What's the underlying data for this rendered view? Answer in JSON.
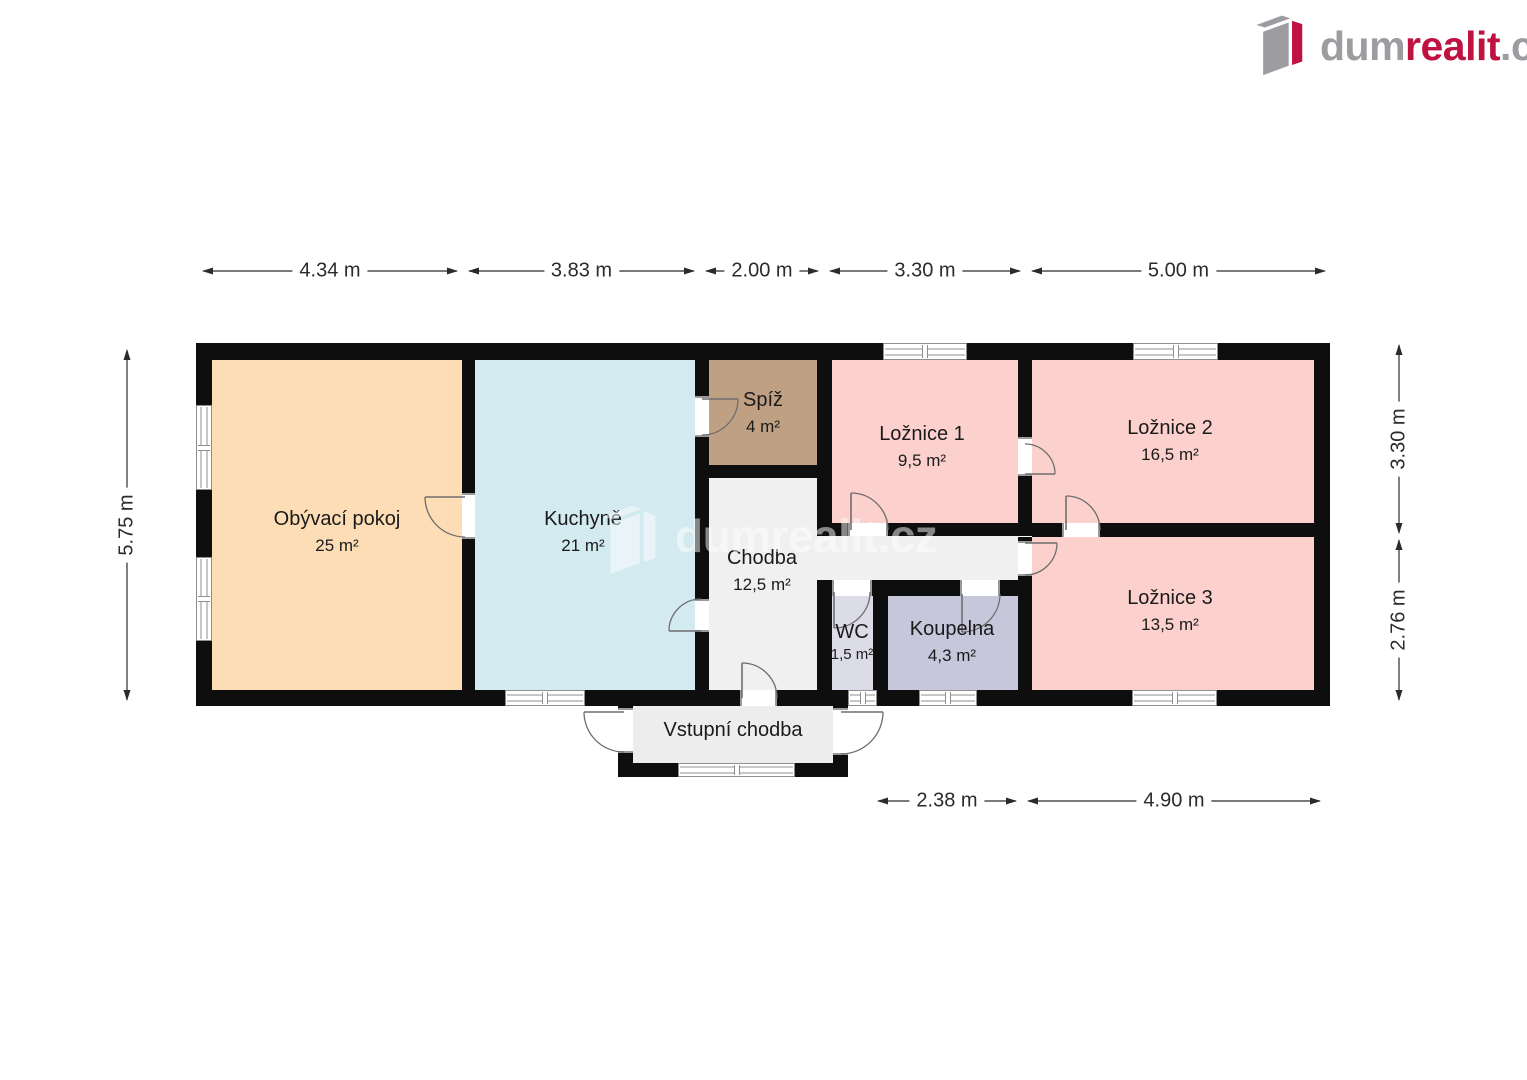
{
  "logo": {
    "text_dum": "dum",
    "text_realit": "realit",
    "text_cz": ".cz",
    "gray": "#9c9ca1",
    "red": "#bf1240"
  },
  "watermark": {
    "text": "dumrealit.cz"
  },
  "floorplan": {
    "wall_color": "#0e0e0e",
    "rooms": [
      {
        "id": "obyvaci-pokoj",
        "name": "Obývací pokoj",
        "area": "25 m²",
        "color": "#fcddb5",
        "rects": [
          [
            212,
            359,
            250,
            332
          ]
        ],
        "label": [
          337,
          508
        ]
      },
      {
        "id": "kuchyne",
        "name": "Kuchyně",
        "area": "21 m²",
        "color": "#d2eaf0",
        "rects": [
          [
            475,
            359,
            220,
            332
          ]
        ],
        "label": [
          583,
          508
        ]
      },
      {
        "id": "spiz",
        "name": "Spíž",
        "area": "4 m²",
        "color": "#bfa083",
        "rects": [
          [
            709,
            359,
            108,
            106
          ]
        ],
        "label": [
          763,
          389
        ]
      },
      {
        "id": "chodba",
        "name": "Chodba",
        "area": "12,5 m²",
        "color": "#f0f0f0",
        "rects": [
          [
            709,
            478,
            108,
            213
          ],
          [
            817,
            536,
            201,
            44
          ]
        ],
        "label": [
          762,
          547
        ]
      },
      {
        "id": "loznice-1",
        "name": "Ložnice 1",
        "area": "9,5 m²",
        "color": "#fbd0cd",
        "rects": [
          [
            832,
            359,
            186,
            164
          ]
        ],
        "label": [
          922,
          423
        ]
      },
      {
        "id": "loznice-2",
        "name": "Ložnice 2",
        "area": "16,5 m²",
        "color": "#fbd0cd",
        "rects": [
          [
            1032,
            359,
            282,
            164
          ]
        ],
        "label": [
          1170,
          417
        ]
      },
      {
        "id": "loznice-3",
        "name": "Ložnice 3",
        "area": "13,5 m²",
        "color": "#fbd0cd",
        "rects": [
          [
            1032,
            537,
            282,
            154
          ]
        ],
        "label": [
          1170,
          587
        ]
      },
      {
        "id": "wc",
        "name": "WC",
        "area": "1,5 m²",
        "color": "#dcdce8",
        "small_area": true,
        "rects": [
          [
            832,
            596,
            41,
            95
          ]
        ],
        "label": [
          852,
          621
        ]
      },
      {
        "id": "koupelna",
        "name": "Koupelna",
        "area": "4,3 m²",
        "color": "#c7c7db",
        "rects": [
          [
            888,
            596,
            130,
            95
          ]
        ],
        "label": [
          952,
          618
        ]
      },
      {
        "id": "vstupni-chodba",
        "name": "Vstupní chodba",
        "area": "",
        "color": "#ededed",
        "rects": [
          [
            633,
            706,
            200,
            57
          ]
        ],
        "label": [
          733,
          719
        ]
      }
    ],
    "walls": [
      [
        196,
        343,
        1134,
        17
      ],
      [
        196,
        690,
        1134,
        16
      ],
      [
        196,
        343,
        16,
        363
      ],
      [
        1314,
        343,
        16,
        363
      ],
      [
        462,
        359,
        13,
        332
      ],
      [
        695,
        359,
        14,
        332
      ],
      [
        817,
        359,
        15,
        177
      ],
      [
        695,
        465,
        137,
        13
      ],
      [
        817,
        580,
        15,
        110
      ],
      [
        832,
        523,
        200,
        13
      ],
      [
        1018,
        359,
        14,
        164
      ],
      [
        1032,
        523,
        298,
        14
      ],
      [
        1018,
        537,
        14,
        153
      ],
      [
        832,
        580,
        200,
        16
      ],
      [
        873,
        596,
        15,
        94
      ],
      [
        618,
        690,
        15,
        87
      ],
      [
        833,
        690,
        15,
        87
      ],
      [
        618,
        763,
        230,
        14
      ]
    ],
    "windows": [
      [
        196,
        405,
        16,
        85,
        "v"
      ],
      [
        196,
        557,
        16,
        84,
        "v"
      ],
      [
        883,
        343,
        84,
        17,
        "h"
      ],
      [
        1133,
        343,
        85,
        17,
        "h"
      ],
      [
        505,
        690,
        80,
        16,
        "h"
      ],
      [
        848,
        690,
        29,
        16,
        "h"
      ],
      [
        919,
        690,
        58,
        16,
        "h"
      ],
      [
        1132,
        690,
        85,
        16,
        "h"
      ],
      [
        678,
        763,
        117,
        14,
        "h"
      ]
    ],
    "doors": [
      {
        "gap": [
          462,
          493,
          13,
          46
        ],
        "o": "v",
        "leaf": [
          465,
          497,
          425,
          497
        ],
        "arc": "M 425 497 A 40 40 0 0 0 465 537"
      },
      {
        "gap": [
          695,
          599,
          14,
          33
        ],
        "o": "v",
        "leaf": [
          701,
          631,
          669,
          631
        ],
        "arc": "M 669 631 A 32 32 0 0 1 701 599"
      },
      {
        "gap": [
          695,
          396,
          14,
          41
        ],
        "o": "v",
        "leaf": [
          702,
          399,
          738,
          399
        ],
        "arc": "M 738 399 A 36 36 0 0 1 702 435"
      },
      {
        "gap": [
          848,
          523,
          40,
          13
        ],
        "o": "h",
        "leaf": [
          851,
          530,
          851,
          493
        ],
        "arc": "M 851 493 A 37 37 0 0 1 888 530"
      },
      {
        "gap": [
          1018,
          437,
          14,
          39
        ],
        "o": "v",
        "leaf": [
          1025,
          474,
          1055,
          474
        ],
        "arc": "M 1025 444 A 30 30 0 0 1 1055 474"
      },
      {
        "gap": [
          1062,
          523,
          38,
          14
        ],
        "o": "h",
        "leaf": [
          1066,
          530,
          1066,
          496
        ],
        "arc": "M 1066 496 A 34 34 0 0 1 1100 530"
      },
      {
        "gap": [
          1018,
          541,
          14,
          35
        ],
        "o": "v",
        "leaf": [
          1025,
          543,
          1057,
          543
        ],
        "arc": "M 1057 543 A 32 32 0 0 1 1025 575"
      },
      {
        "gap": [
          832,
          580,
          40,
          16
        ],
        "o": "h",
        "leaf": [
          834,
          592,
          834,
          628
        ],
        "arc": "M 834 628 A 36 36 0 0 0 870 592"
      },
      {
        "gap": [
          960,
          580,
          40,
          16
        ],
        "o": "h",
        "leaf": [
          962,
          594,
          962,
          632
        ],
        "arc": "M 962 632 A 38 38 0 0 0 1000 594"
      },
      {
        "gap": [
          740,
          690,
          37,
          16
        ],
        "o": "h",
        "leaf": [
          742,
          698,
          742,
          663
        ],
        "arc": "M 742 663 A 35 35 0 0 1 777 698"
      },
      {
        "gap": [
          618,
          708,
          15,
          45
        ],
        "o": "v",
        "leaf": [
          624,
          712,
          584,
          712
        ],
        "arc": "M 584 712 A 40 40 0 0 0 624 752"
      },
      {
        "gap": [
          833,
          708,
          15,
          47
        ],
        "o": "v",
        "leaf": [
          841,
          712,
          883,
          712
        ],
        "arc": "M 883 712 A 42 42 0 0 1 841 754"
      }
    ],
    "dims_h": [
      {
        "label": "4.34 m",
        "x1": 203,
        "x2": 457,
        "y": 271
      },
      {
        "label": "3.83 m",
        "x1": 469,
        "x2": 694,
        "y": 271
      },
      {
        "label": "2.00 m",
        "x1": 706,
        "x2": 818,
        "y": 271
      },
      {
        "label": "3.30 m",
        "x1": 830,
        "x2": 1020,
        "y": 271
      },
      {
        "label": "5.00 m",
        "x1": 1032,
        "x2": 1325,
        "y": 271
      },
      {
        "label": "2.38 m",
        "x1": 878,
        "x2": 1016,
        "y": 801
      },
      {
        "label": "4.90 m",
        "x1": 1028,
        "x2": 1320,
        "y": 801
      }
    ],
    "dims_v": [
      {
        "label": "5.75 m",
        "y1": 350,
        "y2": 700,
        "x": 127
      },
      {
        "label": "3.30 m",
        "y1": 345,
        "y2": 533,
        "x": 1399
      },
      {
        "label": "2.76 m",
        "y1": 540,
        "y2": 700,
        "x": 1399
      }
    ]
  }
}
